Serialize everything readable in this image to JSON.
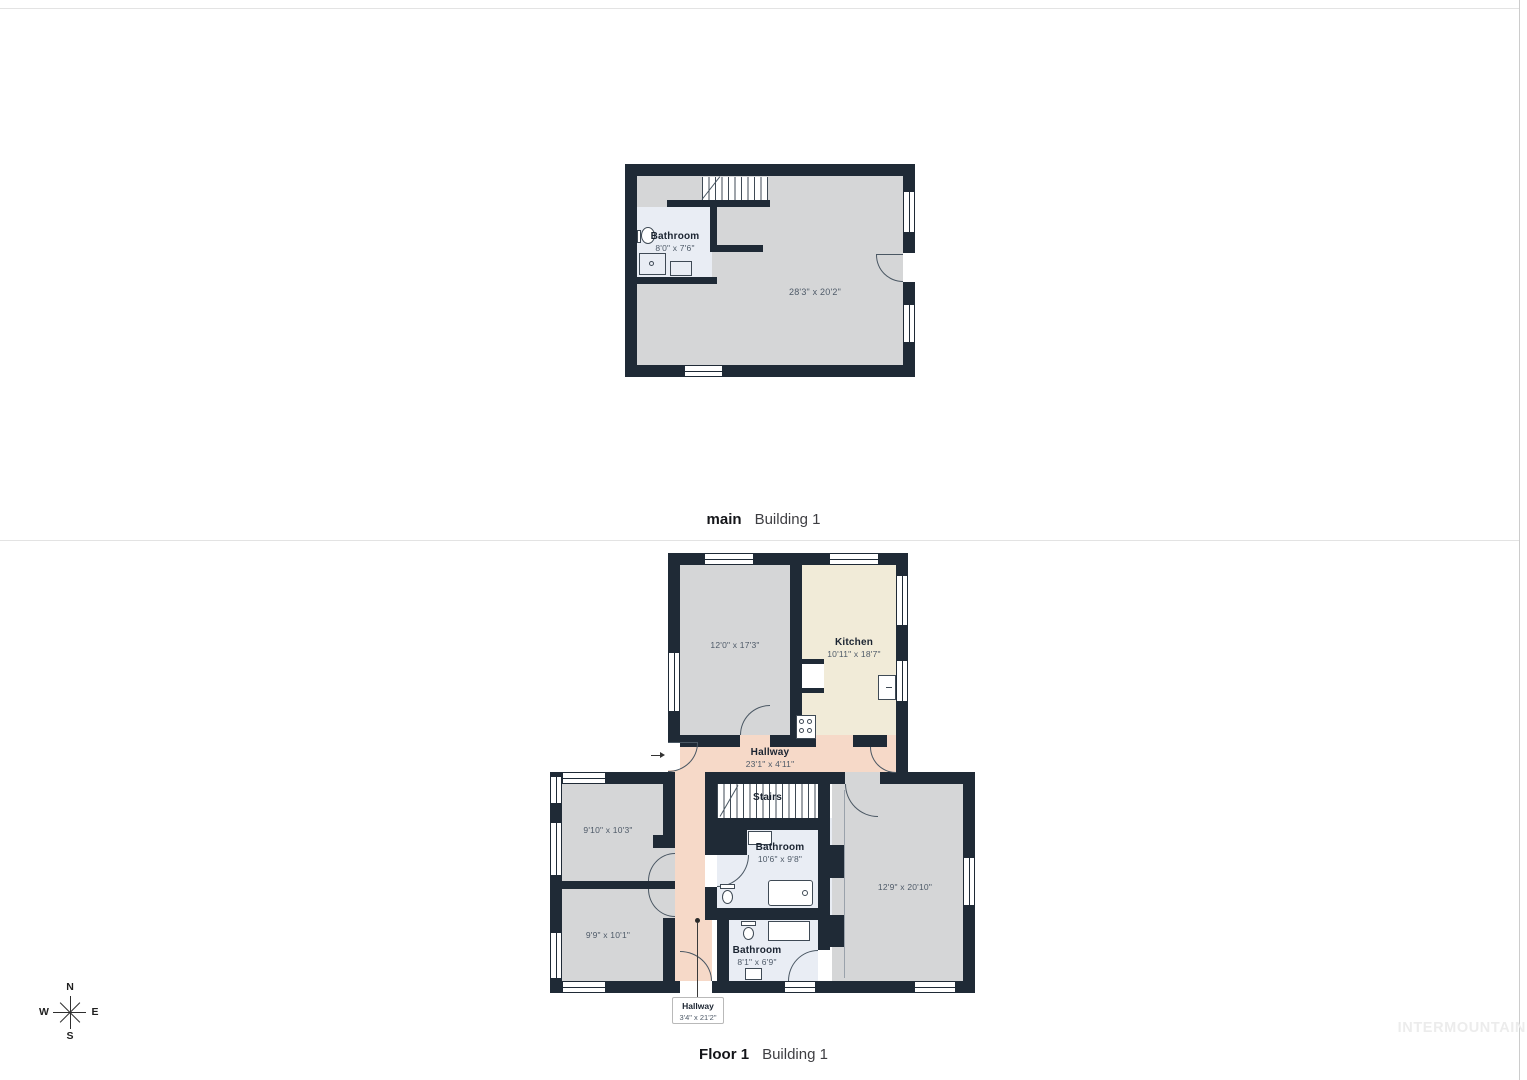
{
  "sections": [
    {
      "floor_label": "main",
      "building_label": "Building 1"
    },
    {
      "floor_label": "Floor 1",
      "building_label": "Building 1"
    }
  ],
  "plan_main": {
    "bathroom_name": "Bathroom",
    "bathroom_dims": "8'0\" x 7'6\"",
    "room_dims": "28'3\" x 20'2\""
  },
  "plan_floor1": {
    "room_a_dims": "12'0\" x 17'3\"",
    "kitchen_name": "Kitchen",
    "kitchen_dims": "10'11\" x 18'7\"",
    "hallway_name": "Hallway",
    "hallway_dims": "23'1\" x 4'11\"",
    "stairs_name": "Stairs",
    "room_b_dims": "9'10\" x 10'3\"",
    "room_c_dims": "9'9\" x 10'1\"",
    "bathroom1_name": "Bathroom",
    "bathroom1_dims": "10'6\" x 9'8\"",
    "room_d_dims": "12'9\" x 20'10\"",
    "bathroom2_name": "Bathroom",
    "bathroom2_dims": "8'1\" x 6'9\"",
    "hallway2_name": "Hallway",
    "hallway2_dims": "3'4\" x 21'2\""
  },
  "compass": {
    "north": "N",
    "east": "E",
    "south": "S",
    "west": "W"
  },
  "watermark": "INTERMOUNTAIN",
  "colors": {
    "wall": "#1f2a36",
    "room_gray": "#d5d6d7",
    "bathroom_blue": "#e9edf4",
    "kitchen_cream": "#f1ebd8",
    "hallway_salmon": "#f6d9c8"
  }
}
